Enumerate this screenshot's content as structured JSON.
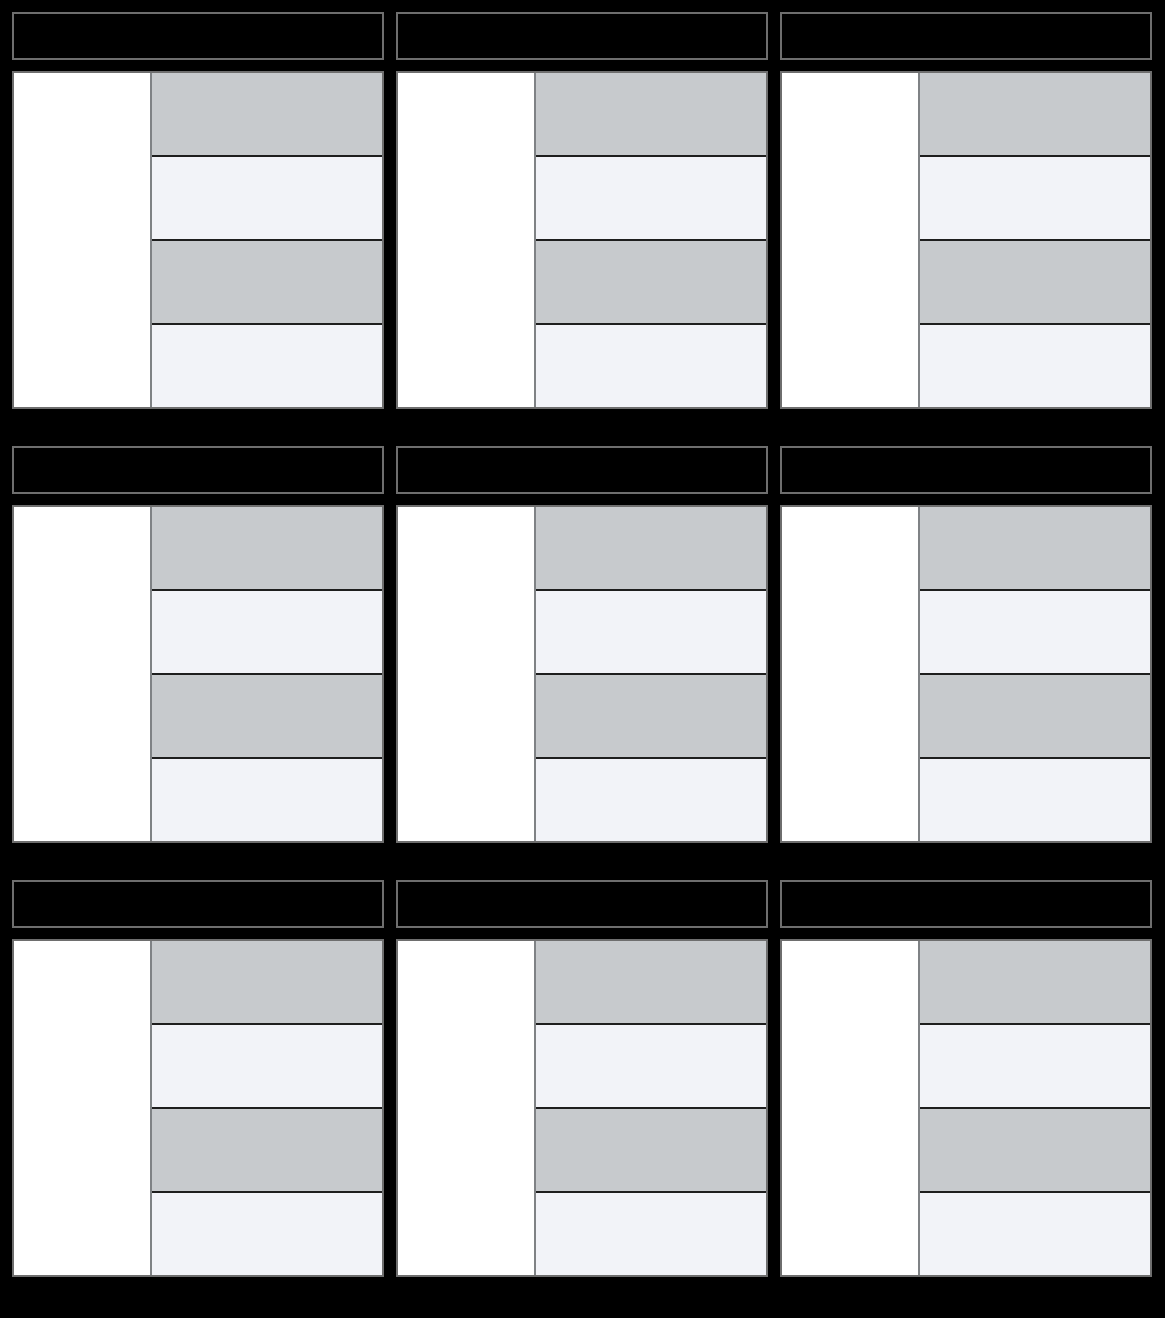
{
  "page": {
    "background": "#000000"
  },
  "palette": {
    "header_bg": "#000000",
    "header_border": "#6e6e6e",
    "body_border": "#6e6e6e",
    "column_divider": "#7f8285",
    "row_divider": "#1e1e1e",
    "left_cell_bg": "#ffffff",
    "stripe_odd": "#c7cacd",
    "stripe_even": "#f2f3f8"
  },
  "grid": {
    "columns": 3,
    "rows": 3,
    "card_count": 9,
    "rows_per_card": 4
  },
  "cards": [
    {
      "title": "",
      "left_cell": "",
      "rows": [
        "",
        "",
        "",
        ""
      ]
    },
    {
      "title": "",
      "left_cell": "",
      "rows": [
        "",
        "",
        "",
        ""
      ]
    },
    {
      "title": "",
      "left_cell": "",
      "rows": [
        "",
        "",
        "",
        ""
      ]
    },
    {
      "title": "",
      "left_cell": "",
      "rows": [
        "",
        "",
        "",
        ""
      ]
    },
    {
      "title": "",
      "left_cell": "",
      "rows": [
        "",
        "",
        "",
        ""
      ]
    },
    {
      "title": "",
      "left_cell": "",
      "rows": [
        "",
        "",
        "",
        ""
      ]
    },
    {
      "title": "",
      "left_cell": "",
      "rows": [
        "",
        "",
        "",
        ""
      ]
    },
    {
      "title": "",
      "left_cell": "",
      "rows": [
        "",
        "",
        "",
        ""
      ]
    },
    {
      "title": "",
      "left_cell": "",
      "rows": [
        "",
        "",
        "",
        ""
      ]
    }
  ]
}
